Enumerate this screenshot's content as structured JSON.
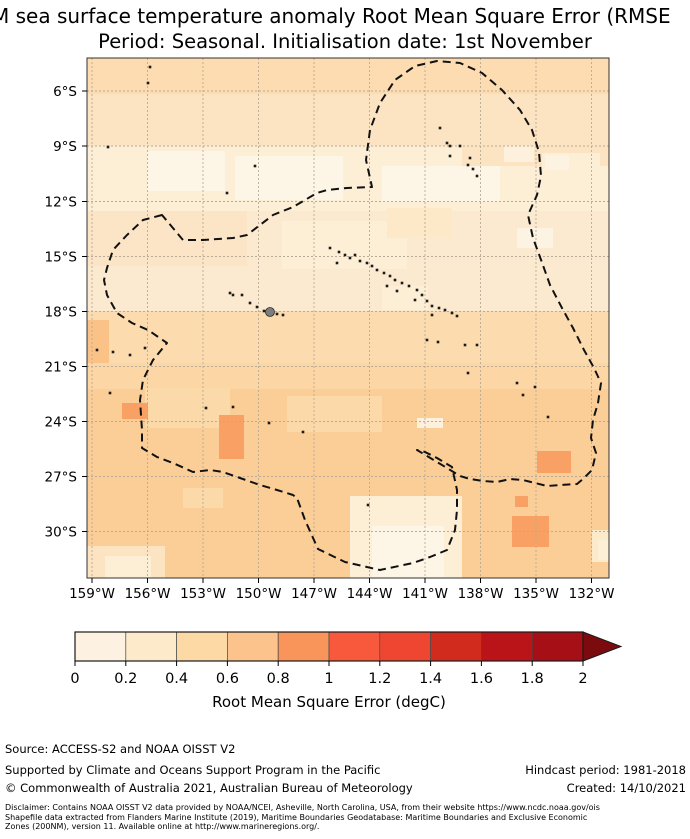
{
  "title": {
    "line1": "M sea surface temperature anomaly Root Mean Square Error (RMSE",
    "line2": "Period: Seasonal. Initialisation date: 1st November"
  },
  "chart_data": {
    "type": "heatmap",
    "title": "M sea surface temperature anomaly Root Mean Square Error (RMSE",
    "subtitle": "Period: Seasonal. Initialisation date: 1st November",
    "x_axis_ticks": [
      "159°W",
      "156°W",
      "153°W",
      "150°W",
      "147°W",
      "144°W",
      "141°W",
      "138°W",
      "135°W",
      "132°W"
    ],
    "y_axis_ticks": [
      "6°S",
      "9°S",
      "12°S",
      "15°S",
      "18°S",
      "21°S",
      "24°S",
      "27°S",
      "30°S"
    ],
    "colorbar": {
      "label": "Root Mean Square Error (degC)",
      "ticks": [
        0,
        0.2,
        0.4,
        0.6,
        0.8,
        1,
        1.2,
        1.4,
        1.6,
        1.8,
        2
      ],
      "range": [
        0,
        2
      ],
      "bin_colors": [
        "#fdf2e1",
        "#fdeaca",
        "#fcd9a5",
        "#fcc48c",
        "#f9945a",
        "#f8593c",
        "#ee4630",
        "#d02b1d",
        "#ba1419",
        "#a50f15"
      ],
      "over_arrow_color": "#7c0b10"
    },
    "overlay": "Dashed black line: Exclusive Economic Zone (200NM) boundary around French Polynesia; black specks: islands; grey filled dot: Tahiti",
    "observed_values_summary": "RMSE mostly 0.2-0.8 degC; lightest band (0.2-0.4) near 9-12S; values 0.6-1.0 south of 18S with small 0.8-1.0 patches"
  },
  "map": {
    "width": 522,
    "height": 520,
    "base_color": "#fce3c1",
    "grid_color": "#b8ab97",
    "border_color": "#333333",
    "boundary_color": "#111111",
    "island_color": "#1a1a1a",
    "lat_ticks": [
      {
        "label": "6°S",
        "y": 33
      },
      {
        "label": "9°S",
        "y": 88
      },
      {
        "label": "12°S",
        "y": 143.5
      },
      {
        "label": "15°S",
        "y": 198.5
      },
      {
        "label": "18°S",
        "y": 253.5
      },
      {
        "label": "21°S",
        "y": 308.5
      },
      {
        "label": "24°S",
        "y": 363.5
      },
      {
        "label": "27°S",
        "y": 418.5
      },
      {
        "label": "30°S",
        "y": 473.5
      }
    ],
    "lon_ticks": [
      {
        "label": "159°W",
        "x": 5
      },
      {
        "label": "156°W",
        "x": 60.5
      },
      {
        "label": "153°W",
        "x": 116
      },
      {
        "label": "150°W",
        "x": 171.5
      },
      {
        "label": "147°W",
        "x": 227
      },
      {
        "label": "144°W",
        "x": 282.5
      },
      {
        "label": "141°W",
        "x": 338
      },
      {
        "label": "138°W",
        "x": 393.5
      },
      {
        "label": "135°W",
        "x": 449
      },
      {
        "label": "132°W",
        "x": 504.5
      }
    ],
    "patches": [
      {
        "x": 0,
        "y": 0,
        "w": 522,
        "h": 36,
        "fill": "#fcdcb0"
      },
      {
        "x": 0,
        "y": 88,
        "w": 375,
        "h": 65,
        "fill": "#fdeed6"
      },
      {
        "x": 375,
        "y": 108,
        "w": 147,
        "h": 45,
        "fill": "#fdeed6"
      },
      {
        "x": 60,
        "y": 93,
        "w": 78,
        "h": 40,
        "fill": "#fdf5e6"
      },
      {
        "x": 148,
        "y": 98,
        "w": 108,
        "h": 44,
        "fill": "#fdf5e6"
      },
      {
        "x": 295,
        "y": 108,
        "w": 118,
        "h": 36,
        "fill": "#fdf5e6"
      },
      {
        "x": 417,
        "y": 88,
        "w": 30,
        "h": 16,
        "fill": "#fdf0dc"
      },
      {
        "x": 455,
        "y": 95,
        "w": 58,
        "h": 20,
        "fill": "#fdeed6"
      },
      {
        "x": 0,
        "y": 153,
        "w": 522,
        "h": 100,
        "fill": "#fcead0"
      },
      {
        "x": 0,
        "y": 153,
        "w": 160,
        "h": 55,
        "fill": "#fce5c6"
      },
      {
        "x": 195,
        "y": 163,
        "w": 125,
        "h": 48,
        "fill": "#fdeed6"
      },
      {
        "x": 300,
        "y": 150,
        "w": 65,
        "h": 30,
        "fill": "#fde9c8"
      },
      {
        "x": 430,
        "y": 170,
        "w": 36,
        "h": 20,
        "fill": "#fdf3e2"
      },
      {
        "x": 295,
        "y": 228,
        "w": 46,
        "h": 24,
        "fill": "#fdeed6"
      },
      {
        "x": 458,
        "y": 97,
        "w": 24,
        "h": 15,
        "fill": "#fdf3e2"
      },
      {
        "x": 0,
        "y": 253,
        "w": 522,
        "h": 55,
        "fill": "#fcdcae"
      },
      {
        "x": 0,
        "y": 262,
        "w": 22,
        "h": 52,
        "fill": "#fbc288"
      },
      {
        "x": 0,
        "y": 305,
        "w": 522,
        "h": 215,
        "fill": "#fbce98"
      },
      {
        "x": 0,
        "y": 305,
        "w": 522,
        "h": 26,
        "fill": "#fcd6a4"
      },
      {
        "x": 58,
        "y": 330,
        "w": 85,
        "h": 40,
        "fill": "#fcd9a8"
      },
      {
        "x": 200,
        "y": 338,
        "w": 95,
        "h": 36,
        "fill": "#fcd9a8"
      },
      {
        "x": 96,
        "y": 430,
        "w": 40,
        "h": 20,
        "fill": "#fcd9a8"
      },
      {
        "x": 330,
        "y": 360,
        "w": 26,
        "h": 10,
        "fill": "#fdf0dc"
      },
      {
        "x": 35,
        "y": 345,
        "w": 26,
        "h": 16,
        "fill": "#f9a164"
      },
      {
        "x": 132,
        "y": 357,
        "w": 25,
        "h": 44,
        "fill": "#f9a164"
      },
      {
        "x": 450,
        "y": 393,
        "w": 34,
        "h": 22,
        "fill": "#f9a164"
      },
      {
        "x": 425,
        "y": 458,
        "w": 37,
        "h": 31,
        "fill": "#f9a164"
      },
      {
        "x": 428,
        "y": 438,
        "w": 13,
        "h": 11,
        "fill": "#f9a164"
      },
      {
        "x": 263,
        "y": 438,
        "w": 112,
        "h": 82,
        "fill": "#fdeed6"
      },
      {
        "x": 285,
        "y": 468,
        "w": 72,
        "h": 52,
        "fill": "#fdf5e6"
      },
      {
        "x": 0,
        "y": 488,
        "w": 78,
        "h": 32,
        "fill": "#fce4c2"
      },
      {
        "x": 18,
        "y": 498,
        "w": 46,
        "h": 22,
        "fill": "#fdeed6"
      },
      {
        "x": 505,
        "y": 472,
        "w": 17,
        "h": 32,
        "fill": "#fdeacb"
      },
      {
        "x": 511,
        "y": 482,
        "w": 11,
        "h": 20,
        "fill": "#fdeed6"
      }
    ],
    "eez_boundary_points": "75,157 56,162 40,177 26,192 20,210 17,222 20,237 30,255 45,265 61,272 80,285 66,302 56,322 53,342 55,372 55,390 70,399 86,405 106,414 123,412 136,414 153,420 173,427 190,432 206,437 210,440 218,462 231,491 258,504 293,512 326,505 343,499 360,492 368,472 370,452 370,432 365,409 350,400 338,394 330,392 345,401 360,410 373,418 383,421 396,423 410,424 423,421 436,422 448,425 460,428 473,427 490,426 496,421 505,412 509,395 504,380 506,362 511,345 514,325 507,310 497,292 486,270 475,250 463,227 453,199 446,180 441,157 450,137 454,118 452,94 445,72 433,52 415,32 395,15 373,5 350,3 328,8 308,22 293,45 283,72 279,102 285,129 260,130 240,132 230,135 206,149 186,157 160,177 146,180 116,182 96,182",
    "islands": [
      [
        353,
        70
      ],
      [
        360,
        85
      ],
      [
        363,
        88
      ],
      [
        373,
        88
      ],
      [
        363,
        98
      ],
      [
        383,
        100
      ],
      [
        381,
        107
      ],
      [
        386,
        111
      ],
      [
        390,
        118
      ],
      [
        243,
        190
      ],
      [
        252,
        194
      ],
      [
        250,
        205
      ],
      [
        258,
        197
      ],
      [
        263,
        200
      ],
      [
        268,
        197
      ],
      [
        273,
        203
      ],
      [
        280,
        205
      ],
      [
        285,
        208
      ],
      [
        290,
        212
      ],
      [
        297,
        215
      ],
      [
        300,
        228
      ],
      [
        303,
        218
      ],
      [
        308,
        222
      ],
      [
        310,
        233
      ],
      [
        315,
        225
      ],
      [
        322,
        228
      ],
      [
        328,
        242
      ],
      [
        330,
        232
      ],
      [
        335,
        237
      ],
      [
        340,
        243
      ],
      [
        345,
        248
      ],
      [
        345,
        257
      ],
      [
        352,
        250
      ],
      [
        358,
        252
      ],
      [
        365,
        255
      ],
      [
        370,
        258
      ],
      [
        143,
        235
      ],
      [
        146,
        237
      ],
      [
        155,
        237
      ],
      [
        163,
        245
      ],
      [
        170,
        249
      ],
      [
        177,
        253
      ],
      [
        190,
        256
      ],
      [
        196,
        257
      ],
      [
        340,
        282
      ],
      [
        351,
        284
      ],
      [
        378,
        287
      ],
      [
        390,
        287
      ],
      [
        381,
        315
      ],
      [
        430,
        325
      ],
      [
        448,
        329
      ],
      [
        436,
        337
      ],
      [
        461,
        359
      ],
      [
        26,
        294
      ],
      [
        43,
        297
      ],
      [
        58,
        290
      ],
      [
        10,
        292
      ],
      [
        119,
        350
      ],
      [
        146,
        349
      ],
      [
        182,
        365
      ],
      [
        216,
        374
      ],
      [
        281,
        447
      ],
      [
        23,
        335
      ],
      [
        63,
        9
      ],
      [
        61,
        25
      ],
      [
        21,
        89
      ],
      [
        168,
        108
      ],
      [
        140,
        135
      ]
    ],
    "tahiti_marker": {
      "x": 183,
      "y": 254,
      "r": 4.5,
      "fill": "#7d7d7d",
      "stroke": "#2a2a2a"
    }
  },
  "colorbar": {
    "x_start": 75,
    "x_end": 583,
    "y_top": 2,
    "height": 29,
    "arrow_tip_x": 621,
    "segment_colors": [
      "#fdf2e1",
      "#fdeaca",
      "#fcd9a5",
      "#fcc48c",
      "#f9945a",
      "#f8593c",
      "#ee4630",
      "#d02b1d",
      "#ba1419",
      "#a50f15"
    ],
    "arrow_color": "#7c0b10",
    "border_color": "#1a1a1a",
    "tick_labels": [
      "0",
      "0.2",
      "0.4",
      "0.6",
      "0.8",
      "1",
      "1.2",
      "1.4",
      "1.6",
      "1.8",
      "2"
    ],
    "label": "Root Mean Square Error (degC)"
  },
  "footer": {
    "source": "Source: ACCESS-S2 and NOAA OISST V2",
    "supported": "Supported by Climate and Oceans Support Program in the Pacific",
    "copyright": "© Commonwealth of Australia 2021, Australian Bureau of Meteorology",
    "hindcast": "Hindcast period: 1981-2018",
    "created": "Created: 14/10/2021",
    "disclaimer_line1": "Disclaimer: Contains NOAA OISST V2 data provided by NOAA/NCEI, Asheville, North Carolina, USA, from their website https://www.ncdc.noaa.gov/ois",
    "disclaimer_line2": "Shapefile data extracted from Flanders Marine Institute (2019), Maritime Boundaries Geodatabase: Maritime Boundaries and Exclusive Economic",
    "disclaimer_line3": "Zones (200NM), version 11. Available online at http://www.marineregions.org/."
  }
}
